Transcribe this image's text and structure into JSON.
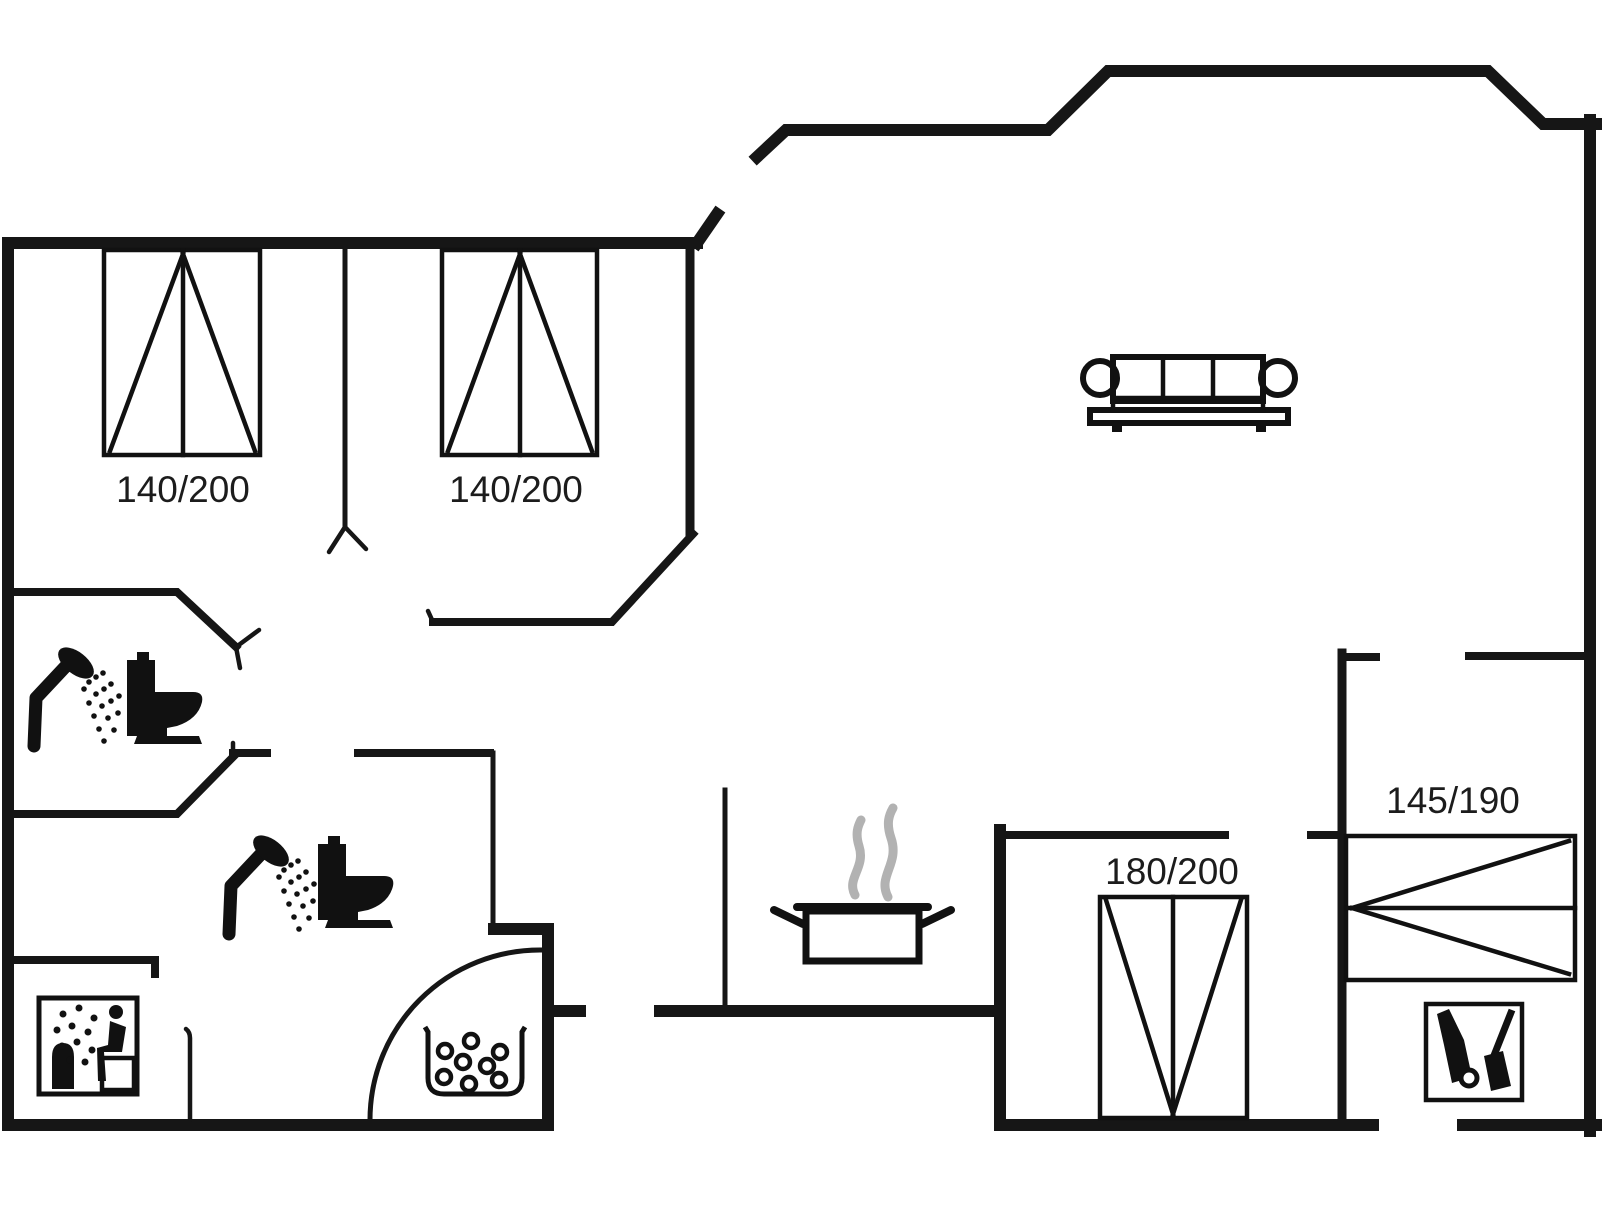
{
  "colors": {
    "wall": "#161616",
    "icon": "#111111",
    "steam": "#b2b2b2",
    "background": "#ffffff",
    "label": "#1c1c1c"
  },
  "beds": {
    "bed_left": {
      "label": "140/200"
    },
    "bed_middle": {
      "label": "140/200"
    },
    "bed_bottom": {
      "label": "180/200"
    },
    "bed_right": {
      "label": "145/190"
    }
  },
  "icons": {
    "shower_1": "shower-icon",
    "toilet_1": "toilet-icon",
    "shower_2": "shower-icon",
    "toilet_2": "toilet-icon",
    "sauna": "sauna-icon",
    "whirlpool": "whirlpool-tub-icon",
    "cooking_pot": "cooking-pot-icon",
    "sofa": "sofa-icon",
    "cleaning": "vacuum-broom-icon",
    "door": "door-swing-arc"
  }
}
